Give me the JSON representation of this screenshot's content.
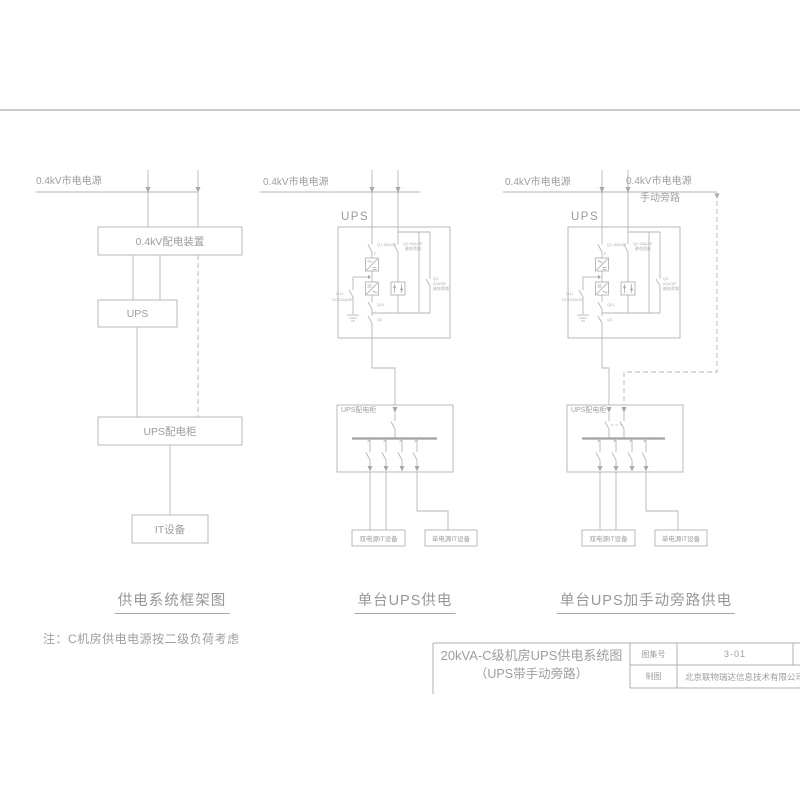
{
  "colors": {
    "line": "#b6b6b6",
    "text": "#9e9e9e"
  },
  "labels": {
    "mains": "0.4kV市电电源",
    "manual_bypass": "手动旁路",
    "dist_box": "0.4kV配电装置",
    "ups": "UPS",
    "ups_cabinet": "UPS配电柜",
    "it": "IT设备",
    "dual_it": "双电源IT设备",
    "single_it": "单电源IT设备"
  },
  "breakers": {
    "q1": "Q1 50A/3P",
    "f": "F",
    "q2_line1": "Q2 63A/3P",
    "q2_line2": "静态旁路",
    "q3_line1": "Q3",
    "q3_line2": "63A/3P",
    "q3_line3": "维修旁路",
    "q11_line1": "Q11",
    "q11_line2": "DC125A/3P",
    "q01": "Q01",
    "q4": "Q4"
  },
  "captions": {
    "left": "供电系统框架图",
    "middle": "单台UPS供电",
    "right": "单台UPS加手动旁路供电"
  },
  "note": "注：C机房供电电源按二级负荷考虑",
  "title_block": {
    "title_line1": "20kVA-C级机房UPS供电系统图",
    "title_line2": "（UPS带手动旁路）",
    "atlas_label": "图集号",
    "atlas_no": "3-01",
    "drawn_label": "制图",
    "company": "北京联物瑞达信息技术有限公司"
  }
}
